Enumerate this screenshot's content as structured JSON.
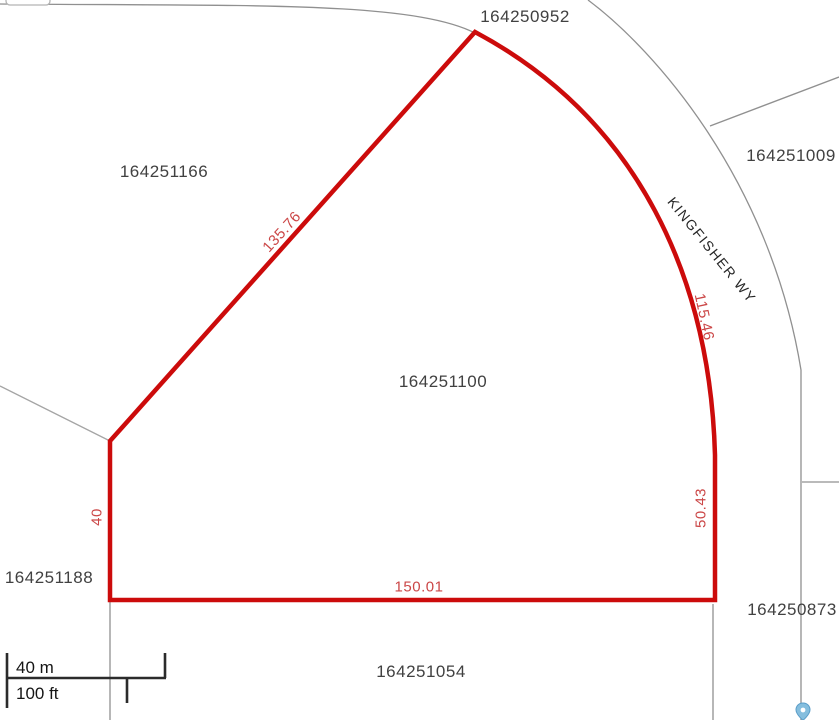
{
  "map": {
    "street_label": "KINGFISHER WY",
    "parcels": [
      {
        "id": "164250952",
        "position": "top"
      },
      {
        "id": "164251166",
        "position": "left"
      },
      {
        "id": "164251009",
        "position": "right"
      },
      {
        "id": "164251100",
        "position": "center-highlighted"
      },
      {
        "id": "164251188",
        "position": "bottom-left"
      },
      {
        "id": "164250873",
        "position": "bottom-right"
      },
      {
        "id": "164251054",
        "position": "bottom-center"
      }
    ],
    "highlight": {
      "parcel_id": "164251100",
      "dimensions": [
        {
          "edge": "northwest-diagonal",
          "value": "135.76"
        },
        {
          "edge": "east-curve",
          "value": "115.46"
        },
        {
          "edge": "east-straight",
          "value": "50.43"
        },
        {
          "edge": "south",
          "value": "150.01"
        },
        {
          "edge": "west",
          "value": "40"
        }
      ]
    },
    "scale_bar": {
      "metric": "40 m",
      "imperial": "100 ft"
    },
    "icons": {
      "map_pin": "map-pin-icon"
    },
    "colors": {
      "highlight_outline": "#cc0b0b",
      "dimension_text": "#cb4747",
      "boundary_line": "#909090",
      "parcel_label_text": "#414141",
      "scale_bar_line": "#2b2b2b",
      "pin_fill": "#85bede",
      "pin_stroke": "#5b9ec9"
    }
  }
}
